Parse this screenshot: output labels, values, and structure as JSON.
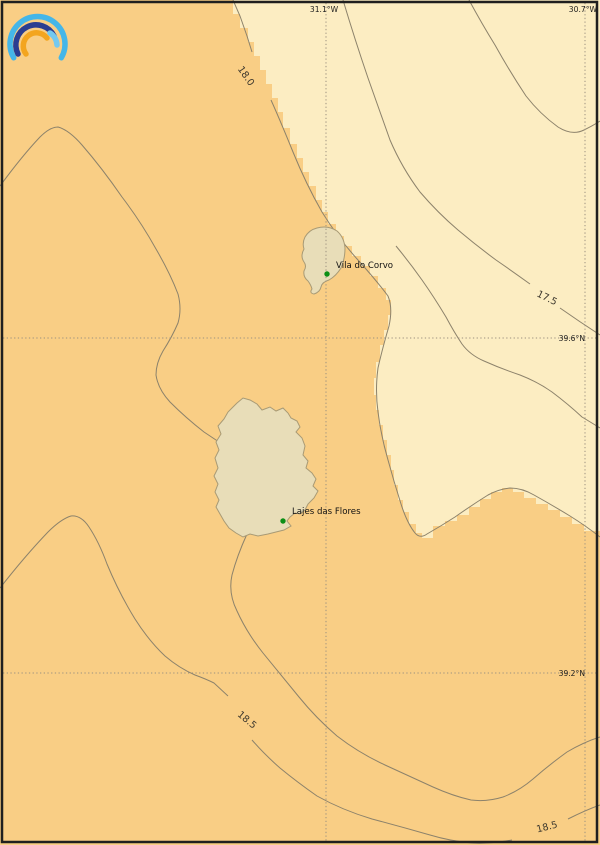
{
  "graticule": {
    "meridians": [
      {
        "label": "31.1°W"
      },
      {
        "label": "30.7°W"
      }
    ],
    "parallels": [
      {
        "label": "39.6°N"
      },
      {
        "label": "39.2°N"
      }
    ]
  },
  "isotherms": [
    {
      "value": "18.0"
    },
    {
      "value": "17.5"
    },
    {
      "value": "18.5"
    },
    {
      "value": "18.5"
    }
  ],
  "places": [
    {
      "name": "Vila do Corvo"
    },
    {
      "name": "Lajes das Flores"
    }
  ],
  "colors": {
    "sea_warm": "#f9ce85",
    "sea_cool": "#fcedc2",
    "island_fill": "#e8ddb8",
    "island_outline": "#a89a75",
    "contour": "#8c826b",
    "contour_label": "#3c372d",
    "graticule": "#9c9180",
    "coord_label": "#1c1c1c",
    "place_label": "#111111",
    "marker_green": "#0c8f15",
    "border": "#1f1f1f",
    "logo_cyan": "#45b6e8",
    "logo_navy": "#2b3d91",
    "logo_orange": "#f3a51f",
    "logo_lightblue": "#74c9ef"
  }
}
